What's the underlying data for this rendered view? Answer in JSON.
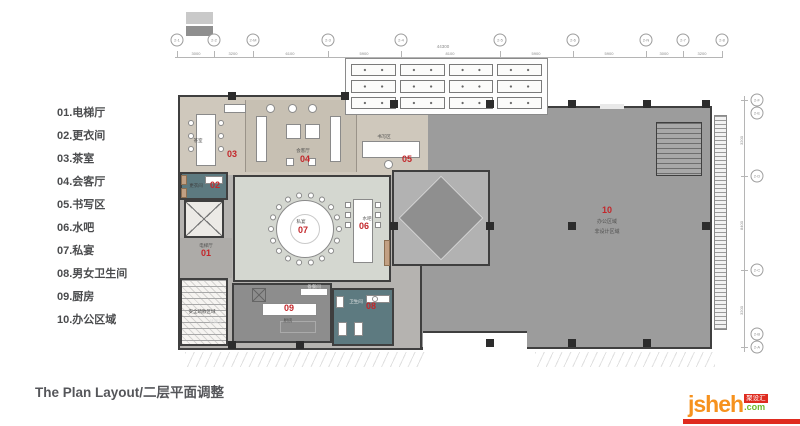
{
  "legend": {
    "items": [
      {
        "label": "01.电梯厅"
      },
      {
        "label": "02.更衣间"
      },
      {
        "label": "03.茶室"
      },
      {
        "label": "04.会客厅"
      },
      {
        "label": "05.书写区"
      },
      {
        "label": "06.水吧"
      },
      {
        "label": "07.私宴"
      },
      {
        "label": "08.男女卫生间"
      },
      {
        "label": "09.厨房"
      },
      {
        "label": "10.办公区域"
      }
    ]
  },
  "footer": {
    "title": "The Plan Layout/二层平面调整"
  },
  "logo": {
    "name": "jsheh",
    "tld": ".com",
    "badge": "聚设汇"
  },
  "plan": {
    "axes": {
      "top_bubbles": [
        "2-1",
        "2-2",
        "2-M",
        "2-3",
        "2-4",
        "2-5",
        "2-6",
        "2-N",
        "2-7",
        "2-8"
      ],
      "right_bubbles": [
        "2-F",
        "2-E",
        "2-D",
        "2-C",
        "2-B",
        "2-A"
      ],
      "top_total": "44300",
      "top_dims": [
        "3000",
        "3200",
        "6100",
        "5900",
        "8100",
        "5900",
        "5900",
        "3000",
        "3200"
      ],
      "right_dims": [
        "3200",
        "8400",
        "3200"
      ]
    },
    "rooms": [
      {
        "num": "01",
        "name": "电梯厅"
      },
      {
        "num": "02",
        "name": "更衣间"
      },
      {
        "num": "03",
        "name": "茶室"
      },
      {
        "num": "04",
        "name": "会客厅"
      },
      {
        "num": "05",
        "name": "书写区"
      },
      {
        "num": "06",
        "name": "水吧"
      },
      {
        "num": "07",
        "name": "私宴"
      },
      {
        "num": "08",
        "name": "卫生间"
      },
      {
        "num": "09",
        "name": "厨房"
      },
      {
        "num": "10",
        "name": "办公区域",
        "sub": "非设计区域"
      }
    ],
    "annotations": {
      "pantry": "备餐间",
      "stair_note": "安全疏散区域",
      "storage": "储藏室"
    }
  },
  "colors": {
    "room_number_red": "#c3272b",
    "teal_room": "#5d7a80",
    "office_gray": "#9c9c9c",
    "banquet_sage": "#d4d7d0",
    "beige_strip": "#cfc8bc",
    "logo_orange": "#f6921e",
    "logo_green": "#6fb92c",
    "logo_red": "#df2b1f"
  }
}
